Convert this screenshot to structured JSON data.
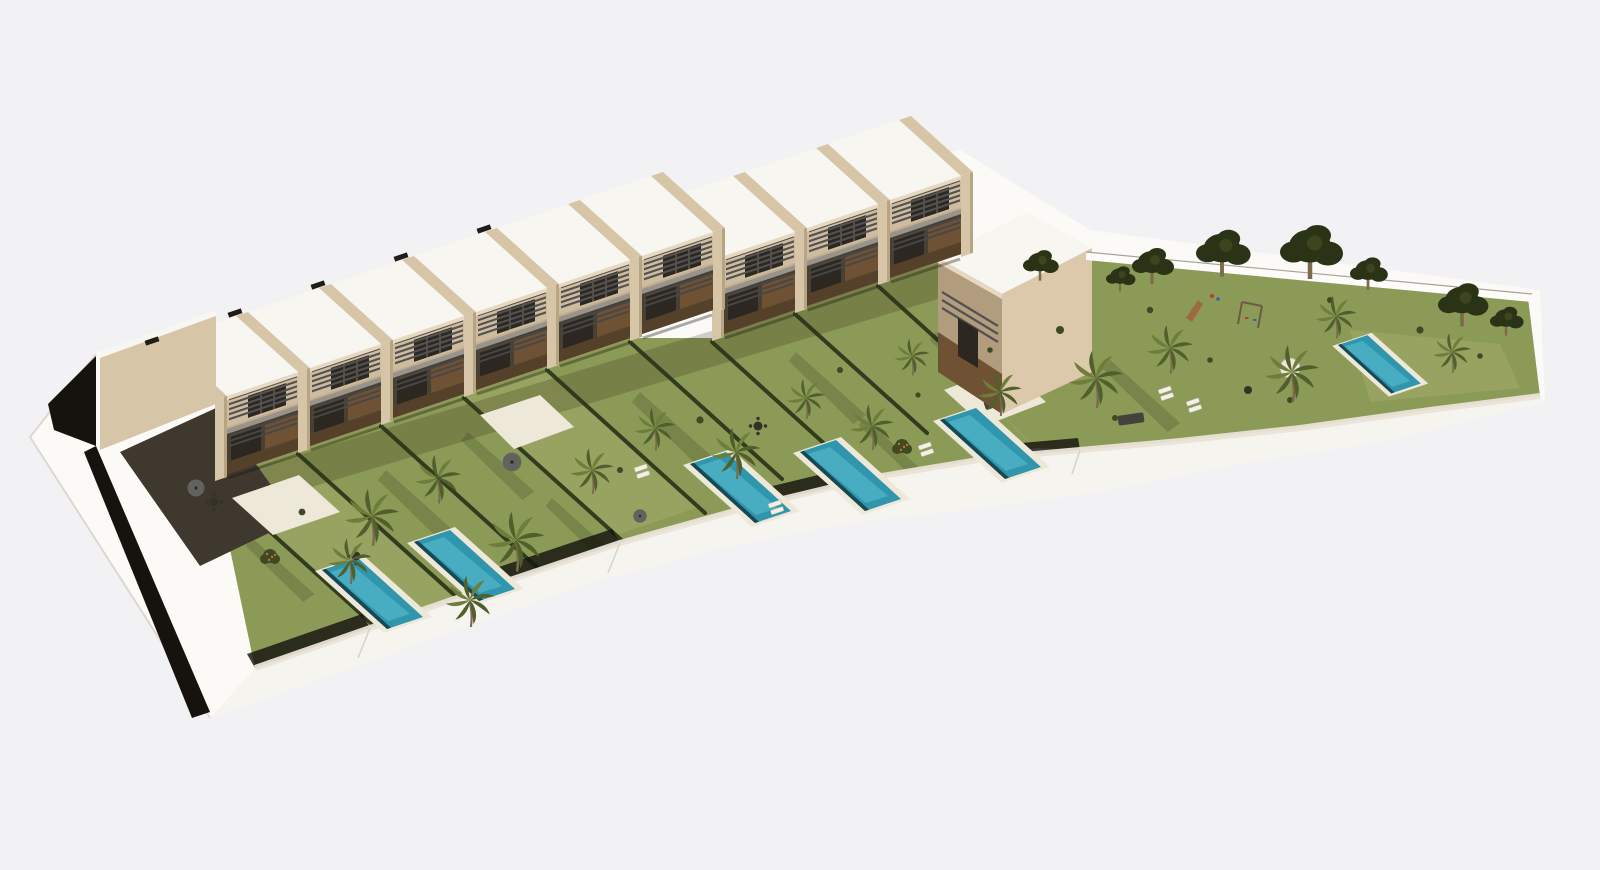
{
  "meta": {
    "description": "Aerial 3D architectural rendering of a modern townhouse development: a diagonal row of flat-roofed houses with beige party walls, slatted pergolas and timber facades, private lawned gardens each with a plunge pool along a stepped white perimeter wall, and a communal garden with trees, palms, a playground and a shared pool, all on a white curved plinth over a plain light-gray background."
  },
  "scene": {
    "counts": {
      "townhouse_units": 9,
      "west_row_units": 6,
      "center_row_units": 3,
      "end_buildings": 1,
      "private_pools": 5,
      "communal_pools": 1,
      "palm_trees": 17,
      "shade_trees": 8,
      "parasols": 3,
      "lounger_pairs": 5,
      "dining_sets": 3
    },
    "features": [
      "flat white roofs",
      "beige party walls",
      "timber facades",
      "slatted pergolas",
      "balconies",
      "private lawns",
      "plunge pools",
      "sun loungers",
      "parasols",
      "communal lawn",
      "playground slide",
      "swing set",
      "perimeter wall",
      "boundary fence",
      "palm trees"
    ],
    "palette": {
      "background": "#f2f2f4",
      "base_white": "#fbfaf7",
      "base_edge": "#dcd8d0",
      "black_base": "#16130f",
      "roof_white": "#f8f6f1",
      "fascia": "#e7d9c1",
      "party_wall": "#d7c5a8",
      "party_shade": "#b7a483",
      "recess_wall": "#c2ae90",
      "upper_wall": "#cfbb9d",
      "window_glass": "#2d2721",
      "mullion": "#7c7466",
      "wood": "#6f5134",
      "wood_dark": "#55402a",
      "terrace": "#494034",
      "balcony": "#98948c",
      "slat": "#525252",
      "slat2": "#474747",
      "lawn": "#8c9a57",
      "lawn_light": "#a2ac69",
      "hedge": "#2b3319",
      "shrub": "#3d4a23",
      "tree_dark": "#2b3317",
      "tree_hi": "#3b451f",
      "palm_green": "#50602d",
      "palm_light": "#6d7d3a",
      "trunk": "#7b6a4d",
      "pool_deck": "#eee8d8",
      "pool_water": "#2f96ad",
      "pool_shine": "#62c4d6",
      "pool_shadow": "#11343c",
      "wall_band": "#f6f4ef",
      "wall_walkway": "#e9e3d7",
      "wall_seam": "#d8d2c7",
      "terrace_dark": "#3f382e",
      "white_furniture": "#f3f0e7",
      "dark_furniture": "#34302a",
      "umbrella": "#63625e",
      "sofa": "#44423d",
      "fence_white": "#fdfcfa",
      "fence_line": "#a8a39a",
      "tick": "#201d18",
      "shadow_streak": "rgba(15,18,6,0.16)",
      "building_shadow": "rgba(30,24,12,0.20)",
      "clubhouse_front": "#b29c7e",
      "clubhouse_side": "#dcc9ab",
      "orange_fruit": "#c96f2a",
      "play_red": "#b04434",
      "play_blue": "#3a62a8",
      "play_wood": "#9a6b43"
    }
  }
}
